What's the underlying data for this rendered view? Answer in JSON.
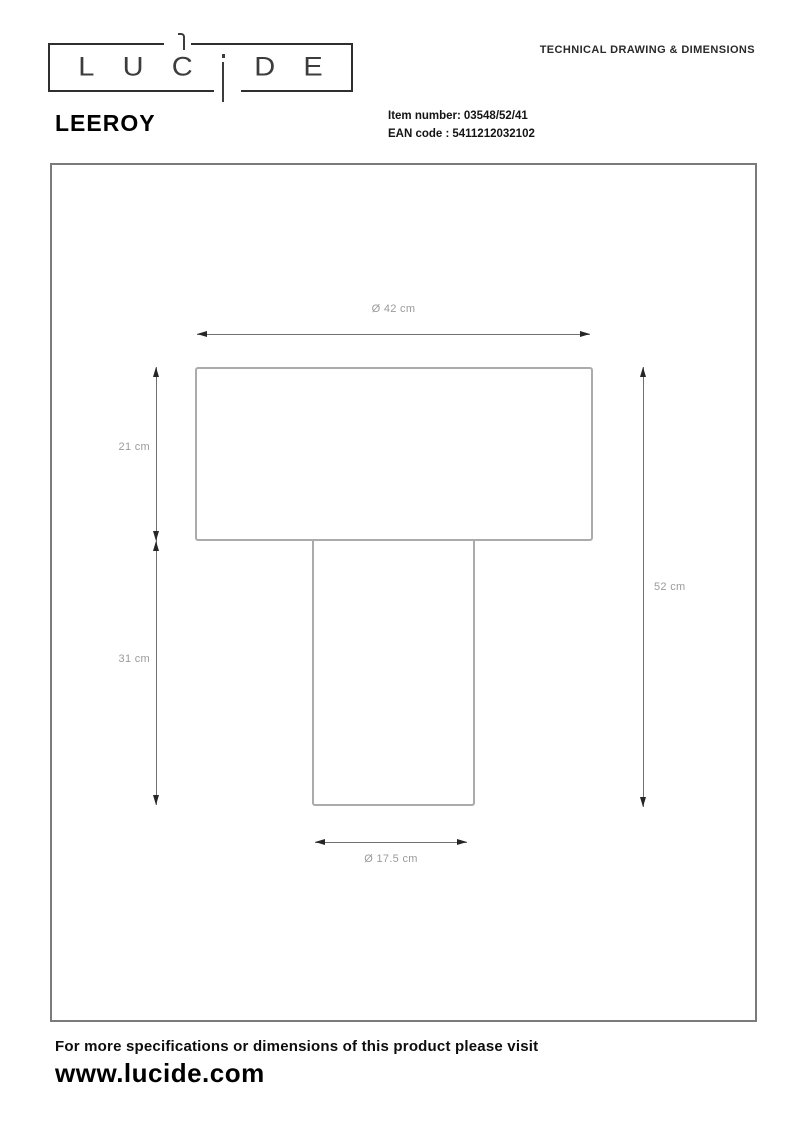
{
  "header": {
    "logo_text": "LUCIDE",
    "logo_letters": [
      "L",
      "U",
      "C",
      "D",
      "E"
    ],
    "doc_type": "TECHNICAL DRAWING & DIMENSIONS"
  },
  "product": {
    "name": "LEEROY",
    "item_number_label": "Item number:",
    "item_number_value": "03548/52/41",
    "ean_label": "EAN code :",
    "ean_value": "5411212032102"
  },
  "drawing": {
    "shade_diameter_label": "Ø 42 cm",
    "shade_height_label": "21 cm",
    "base_height_label": "31 cm",
    "total_height_label": "52 cm",
    "foot_diameter_label": "Ø 17.5 cm"
  },
  "footer": {
    "note": "For more specifications or dimensions of this product please visit",
    "website": "www.lucide.com"
  },
  "colors": {
    "outline_gray": "#ababab",
    "dimension_line_gray": "#707070",
    "arrowhead_dark": "#262626",
    "label_gray": "#9b9b9b",
    "frame_border_gray": "#7b7b7b",
    "text_black": "#1a1a1a"
  }
}
